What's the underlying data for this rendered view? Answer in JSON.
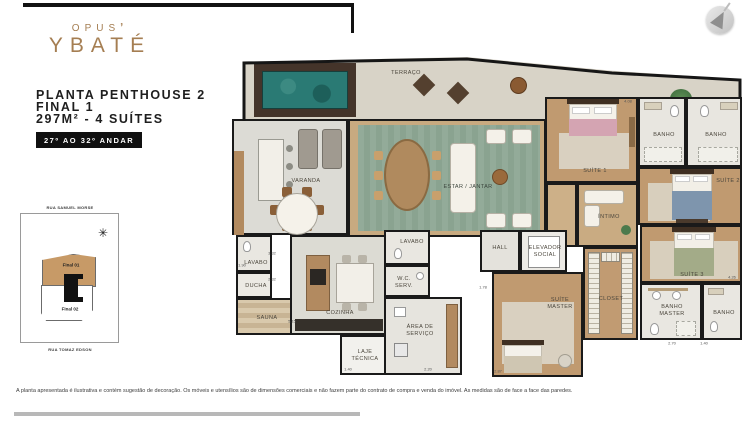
{
  "header": {
    "logo_top": "OPUS",
    "logo_mark": "ʼ",
    "logo_main": "YBATÉ",
    "title_line1": "PLANTA PENTHOUSE 2",
    "title_line2": "FINAL 1",
    "title_line3": "297M² - 4 SUÍTES",
    "badge": "27º AO 32º ANDAR"
  },
  "key_plan": {
    "street_top": "RUA SAMUEL MORSE",
    "street_bottom": "RUA TOMAZ EDSON",
    "unit_highlight": "Final 01",
    "unit_other": "Final 02",
    "compass": "✳"
  },
  "plan": {
    "rooms": {
      "terraco": "TERRAÇO",
      "varanda": "VARANDA",
      "estar": "ESTAR / JANTAR",
      "suite1": "SUÍTE 1",
      "banho1": "BANHO",
      "banho2": "BANHO",
      "suite2": "SUÍTE 2",
      "intimo": "ÍNTIMO",
      "suite3": "SUÍTE 3",
      "closet": "CLOSET",
      "suite_master": "SUÍTE MASTER",
      "banho_master": "BANHO MASTER",
      "banho3": "BANHO",
      "hall": "HALL",
      "elevador": "ELEVADOR SOCIAL",
      "lavabo_spa": "LAVABO",
      "ducha": "DUCHA",
      "sauna": "SAUNA",
      "cozinha": "COZINHA",
      "lavabo": "LAVABO",
      "wc_serv": "W.C. SERV.",
      "area_servico": "ÁREA DE SERVIÇO",
      "laje_tecnica": "LAJE TÉCNICA"
    },
    "dimensions": [
      {
        "x": 396,
        "y": 44,
        "label": "4.08"
      },
      {
        "x": 60,
        "y": 264,
        "label": "5.15"
      },
      {
        "x": 40,
        "y": 196,
        "label": "3.32"
      },
      {
        "x": 40,
        "y": 222,
        "label": "2.32"
      },
      {
        "x": 10,
        "y": 208,
        "label": "1.90"
      },
      {
        "x": 196,
        "y": 312,
        "label": "2.20"
      },
      {
        "x": 116,
        "y": 312,
        "label": "1.40"
      },
      {
        "x": 251,
        "y": 230,
        "label": "1.78"
      },
      {
        "x": 266,
        "y": 314,
        "label": "2.87"
      },
      {
        "x": 500,
        "y": 220,
        "label": "4.26"
      },
      {
        "x": 440,
        "y": 286,
        "label": "2.70"
      },
      {
        "x": 472,
        "y": 286,
        "label": "1.40"
      }
    ]
  },
  "disclaimer": "A planta apresentada é ilustrativa e contém sugestão de decoração. Os móveis e utensílios são de dimensões comerciais e não fazem parte do contrato de compra e venda do imóvel. As medidas são de face a face das paredes.",
  "colors": {
    "accent_bronze": "#a57e52",
    "wall": "#1a1a1a",
    "pool": "#2a7a74",
    "deck_wood": "#44342a",
    "rug_green": "#93ab99",
    "wood_floor": "#c8aa80",
    "highlight_tan": "#c79a67",
    "badge_bg": "#101010"
  }
}
